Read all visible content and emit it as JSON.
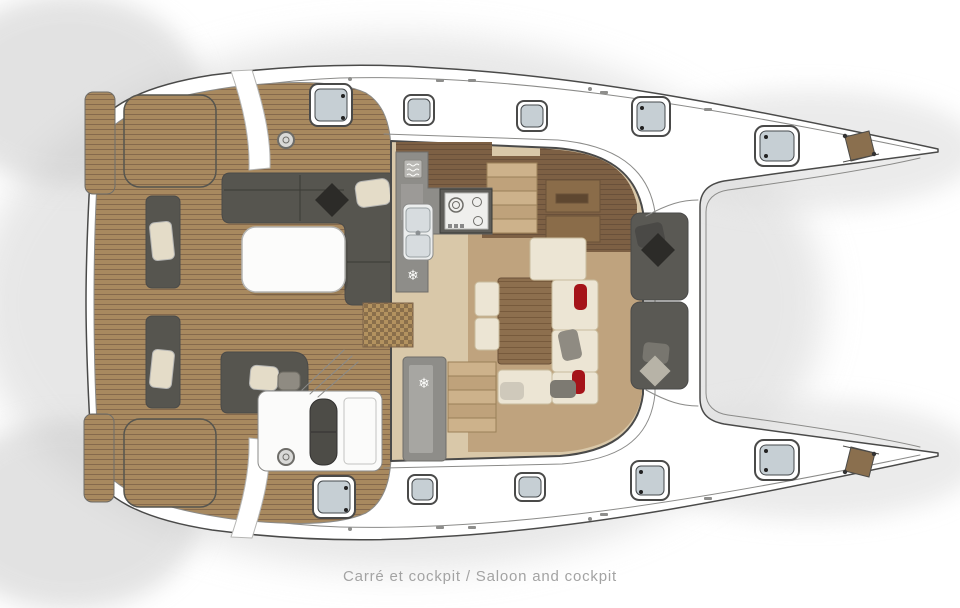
{
  "caption": {
    "text": "Carré et cockpit / Saloon and cockpit"
  },
  "icons": {
    "snowflake": "❄",
    "fridge_icon_name": "snowflake-icon",
    "oven_icon_name": "oven-icon"
  },
  "colors": {
    "outline": "#4a4a49",
    "hull_white": "#ffffff",
    "teak": "#a8895f",
    "teak_line": "#85694c",
    "saloon_floor": "#d9c8a9",
    "dais_wood": "#bfa37e",
    "cabinet_wood": "#7d6044",
    "table_wood": "#8d6f4e",
    "counter_gray": "#8e8d89",
    "stove_dark": "#5f5e5a",
    "sofa_dark": "#56554f",
    "cushion_cream": "#ece5d4",
    "pillow_red": "#a51319",
    "hatch_glass": "#c6cfd4",
    "caption_gray": "#a3a3a3"
  }
}
